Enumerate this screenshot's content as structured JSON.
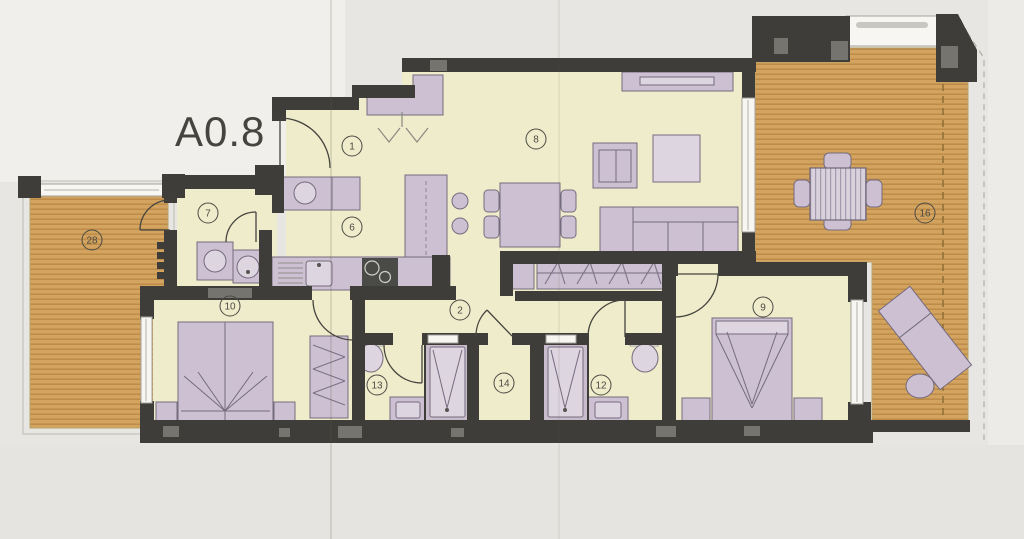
{
  "plan": {
    "title": "A0.8"
  },
  "rooms": [
    {
      "id": "entry",
      "label": "1"
    },
    {
      "id": "corridor",
      "label": "2"
    },
    {
      "id": "kitchen",
      "label": "6"
    },
    {
      "id": "utility",
      "label": "7"
    },
    {
      "id": "living-dining",
      "label": "8"
    },
    {
      "id": "bedroom-2",
      "label": "9"
    },
    {
      "id": "bedroom-1",
      "label": "10"
    },
    {
      "id": "bathroom-2",
      "label": "12"
    },
    {
      "id": "bathroom-1",
      "label": "13"
    },
    {
      "id": "inner-hall",
      "label": "14"
    },
    {
      "id": "terrace-east",
      "label": "16"
    },
    {
      "id": "terrace-west",
      "label": "28"
    }
  ],
  "colors": {
    "wall": "#3e3d3a",
    "wall_light": "#75746e",
    "floor": "#eeecca",
    "deck": "#d2a45f",
    "deck_line": "#b5813d",
    "furniture": "#cdc0d2",
    "furniture_line": "#756b7e",
    "furniture_light": "#ddd5e0",
    "paper": "#e8e6e2",
    "paper_light": "#f0efeb",
    "ink": "#4c4b45",
    "window": "#f7f6f2"
  }
}
